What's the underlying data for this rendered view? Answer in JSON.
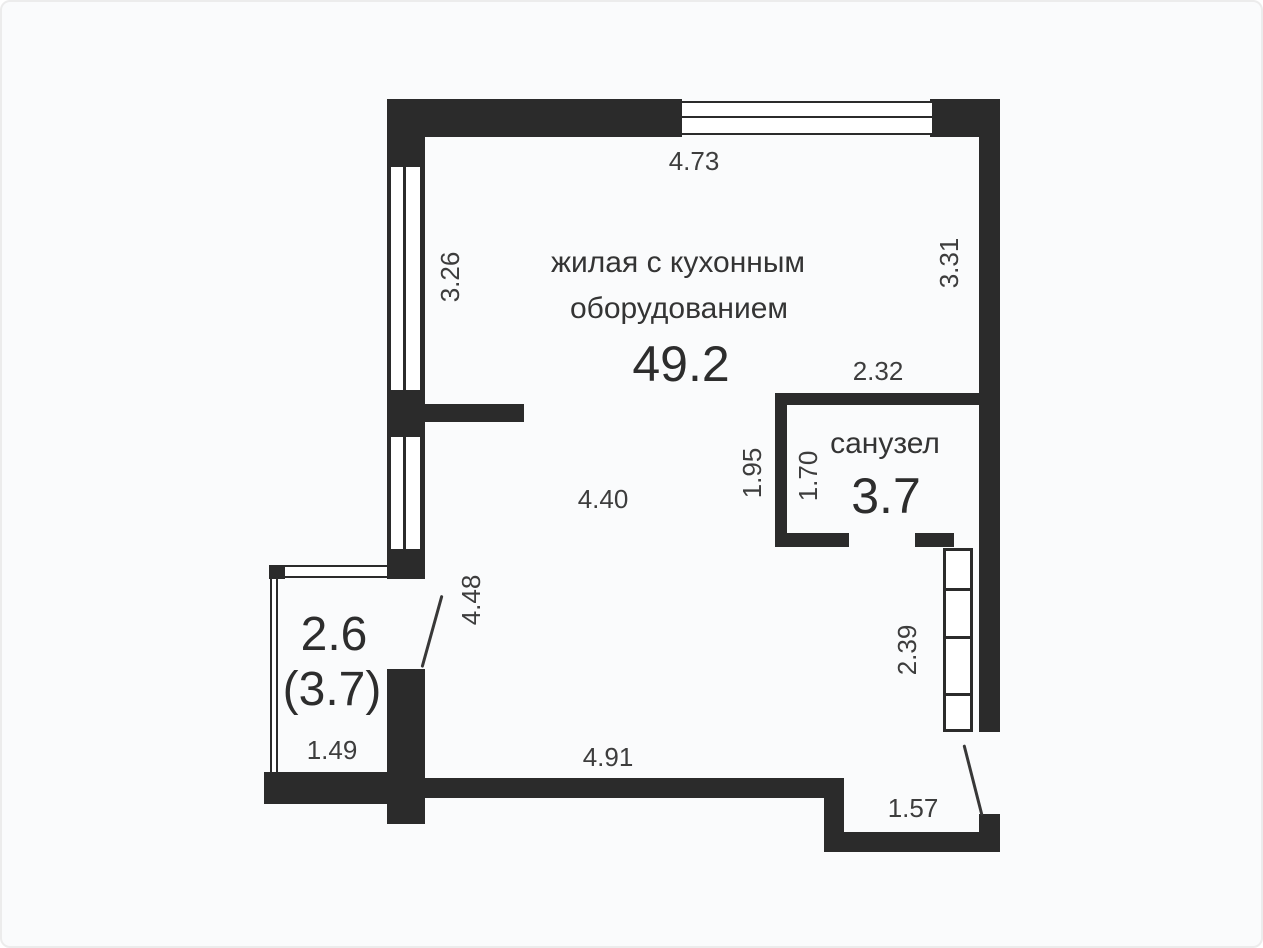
{
  "floor_plan": {
    "main_room": {
      "name_line1": "жилая с кухонным",
      "name_line2": "оборудованием",
      "area": "49.2"
    },
    "bathroom": {
      "name": "санузел",
      "area": "3.7"
    },
    "balcony": {
      "area": "2.6",
      "area_alt": "(3.7)"
    },
    "dimensions": {
      "top_width": "4.73",
      "left_window_height": "3.26",
      "right_height": "3.31",
      "bathroom_width": "2.32",
      "bathroom_outer_height": "1.95",
      "bathroom_inner_height": "1.70",
      "room_width": "4.40",
      "balcony_wall_height": "4.48",
      "closet_height": "2.39",
      "balcony_width": "1.49",
      "bottom_width": "4.91",
      "entrance_width": "1.57"
    },
    "colors": {
      "wall": "#2b2b2b",
      "text": "#3d3d3d",
      "background": "#fafbfc"
    }
  }
}
